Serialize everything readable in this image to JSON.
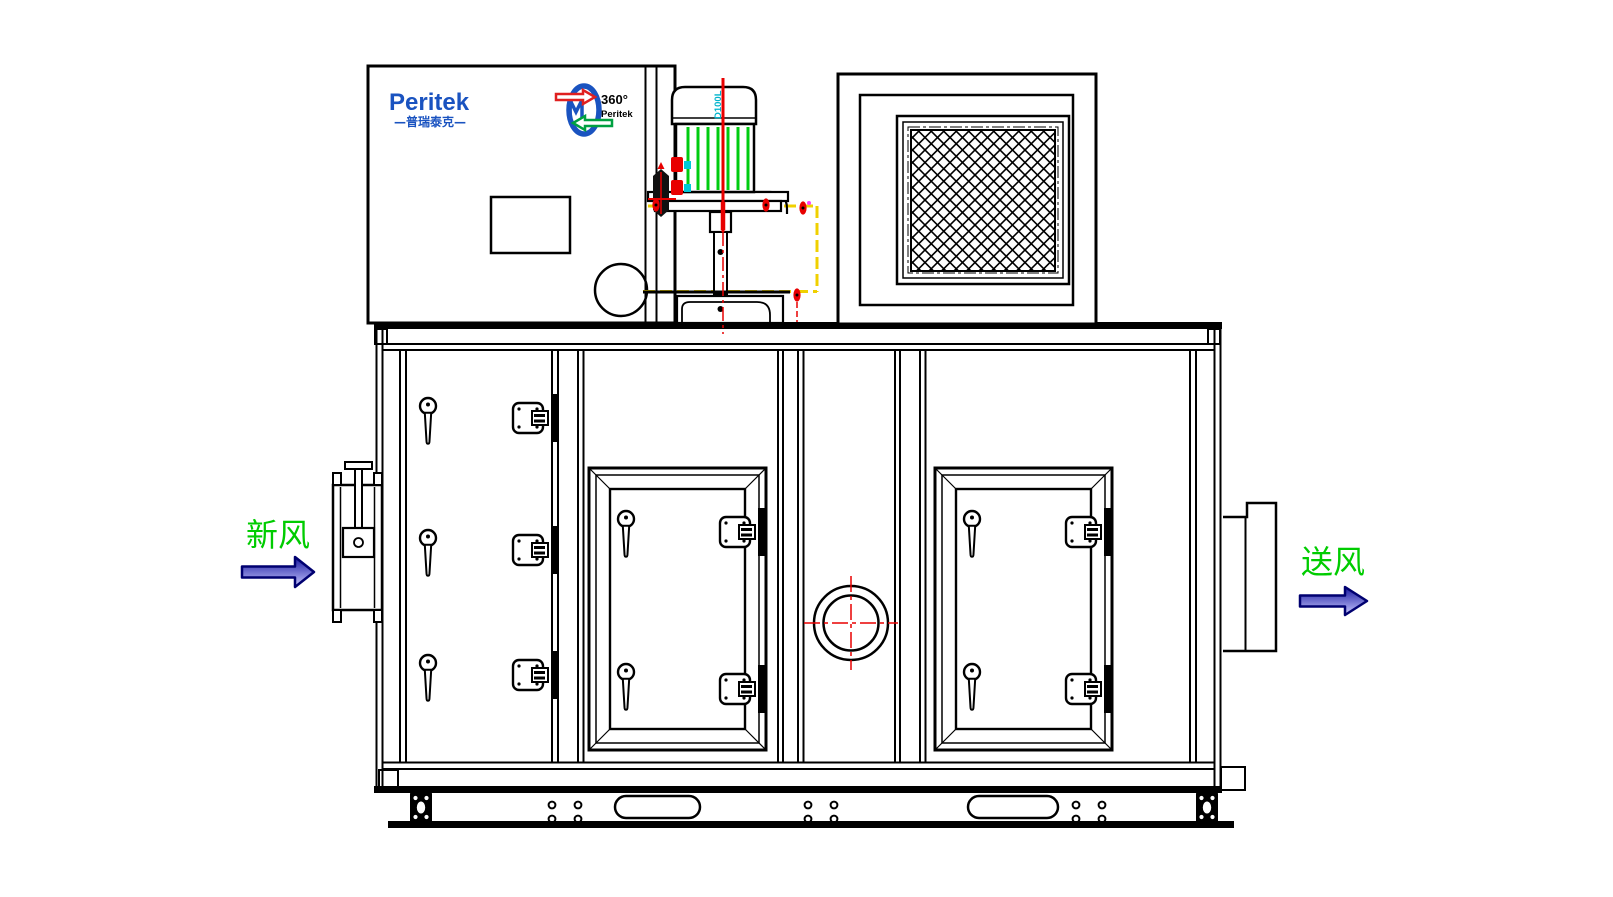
{
  "meta": {
    "drawing_type": "engineering front elevation",
    "subject": "Peritek rotary desiccant dehumidifier air handling unit"
  },
  "brand": {
    "logo_text": "Peritek",
    "logo_sub": "—普瑞泰克—",
    "rotor_badge_top": "360°",
    "rotor_badge_bottom": "Peritek"
  },
  "motor": {
    "model_label": "D100L"
  },
  "flow_labels": {
    "inlet": "新风",
    "outlet": "送风"
  },
  "colors": {
    "line_black": "#000000",
    "brand_blue": "#1a53c0",
    "fin_green": "#00cc10",
    "label_green": "#00cc00",
    "centerline_red": "#e80000",
    "guard_yellow": "#f0d000",
    "cyan_detail": "#00b4cc",
    "arrow_outline_navy": "#000070",
    "arrow_fill_dark": "#1818a0",
    "arrow_fill_light": "#c8c8ff",
    "badge_red": "#e02020",
    "badge_green": "#00a040"
  }
}
